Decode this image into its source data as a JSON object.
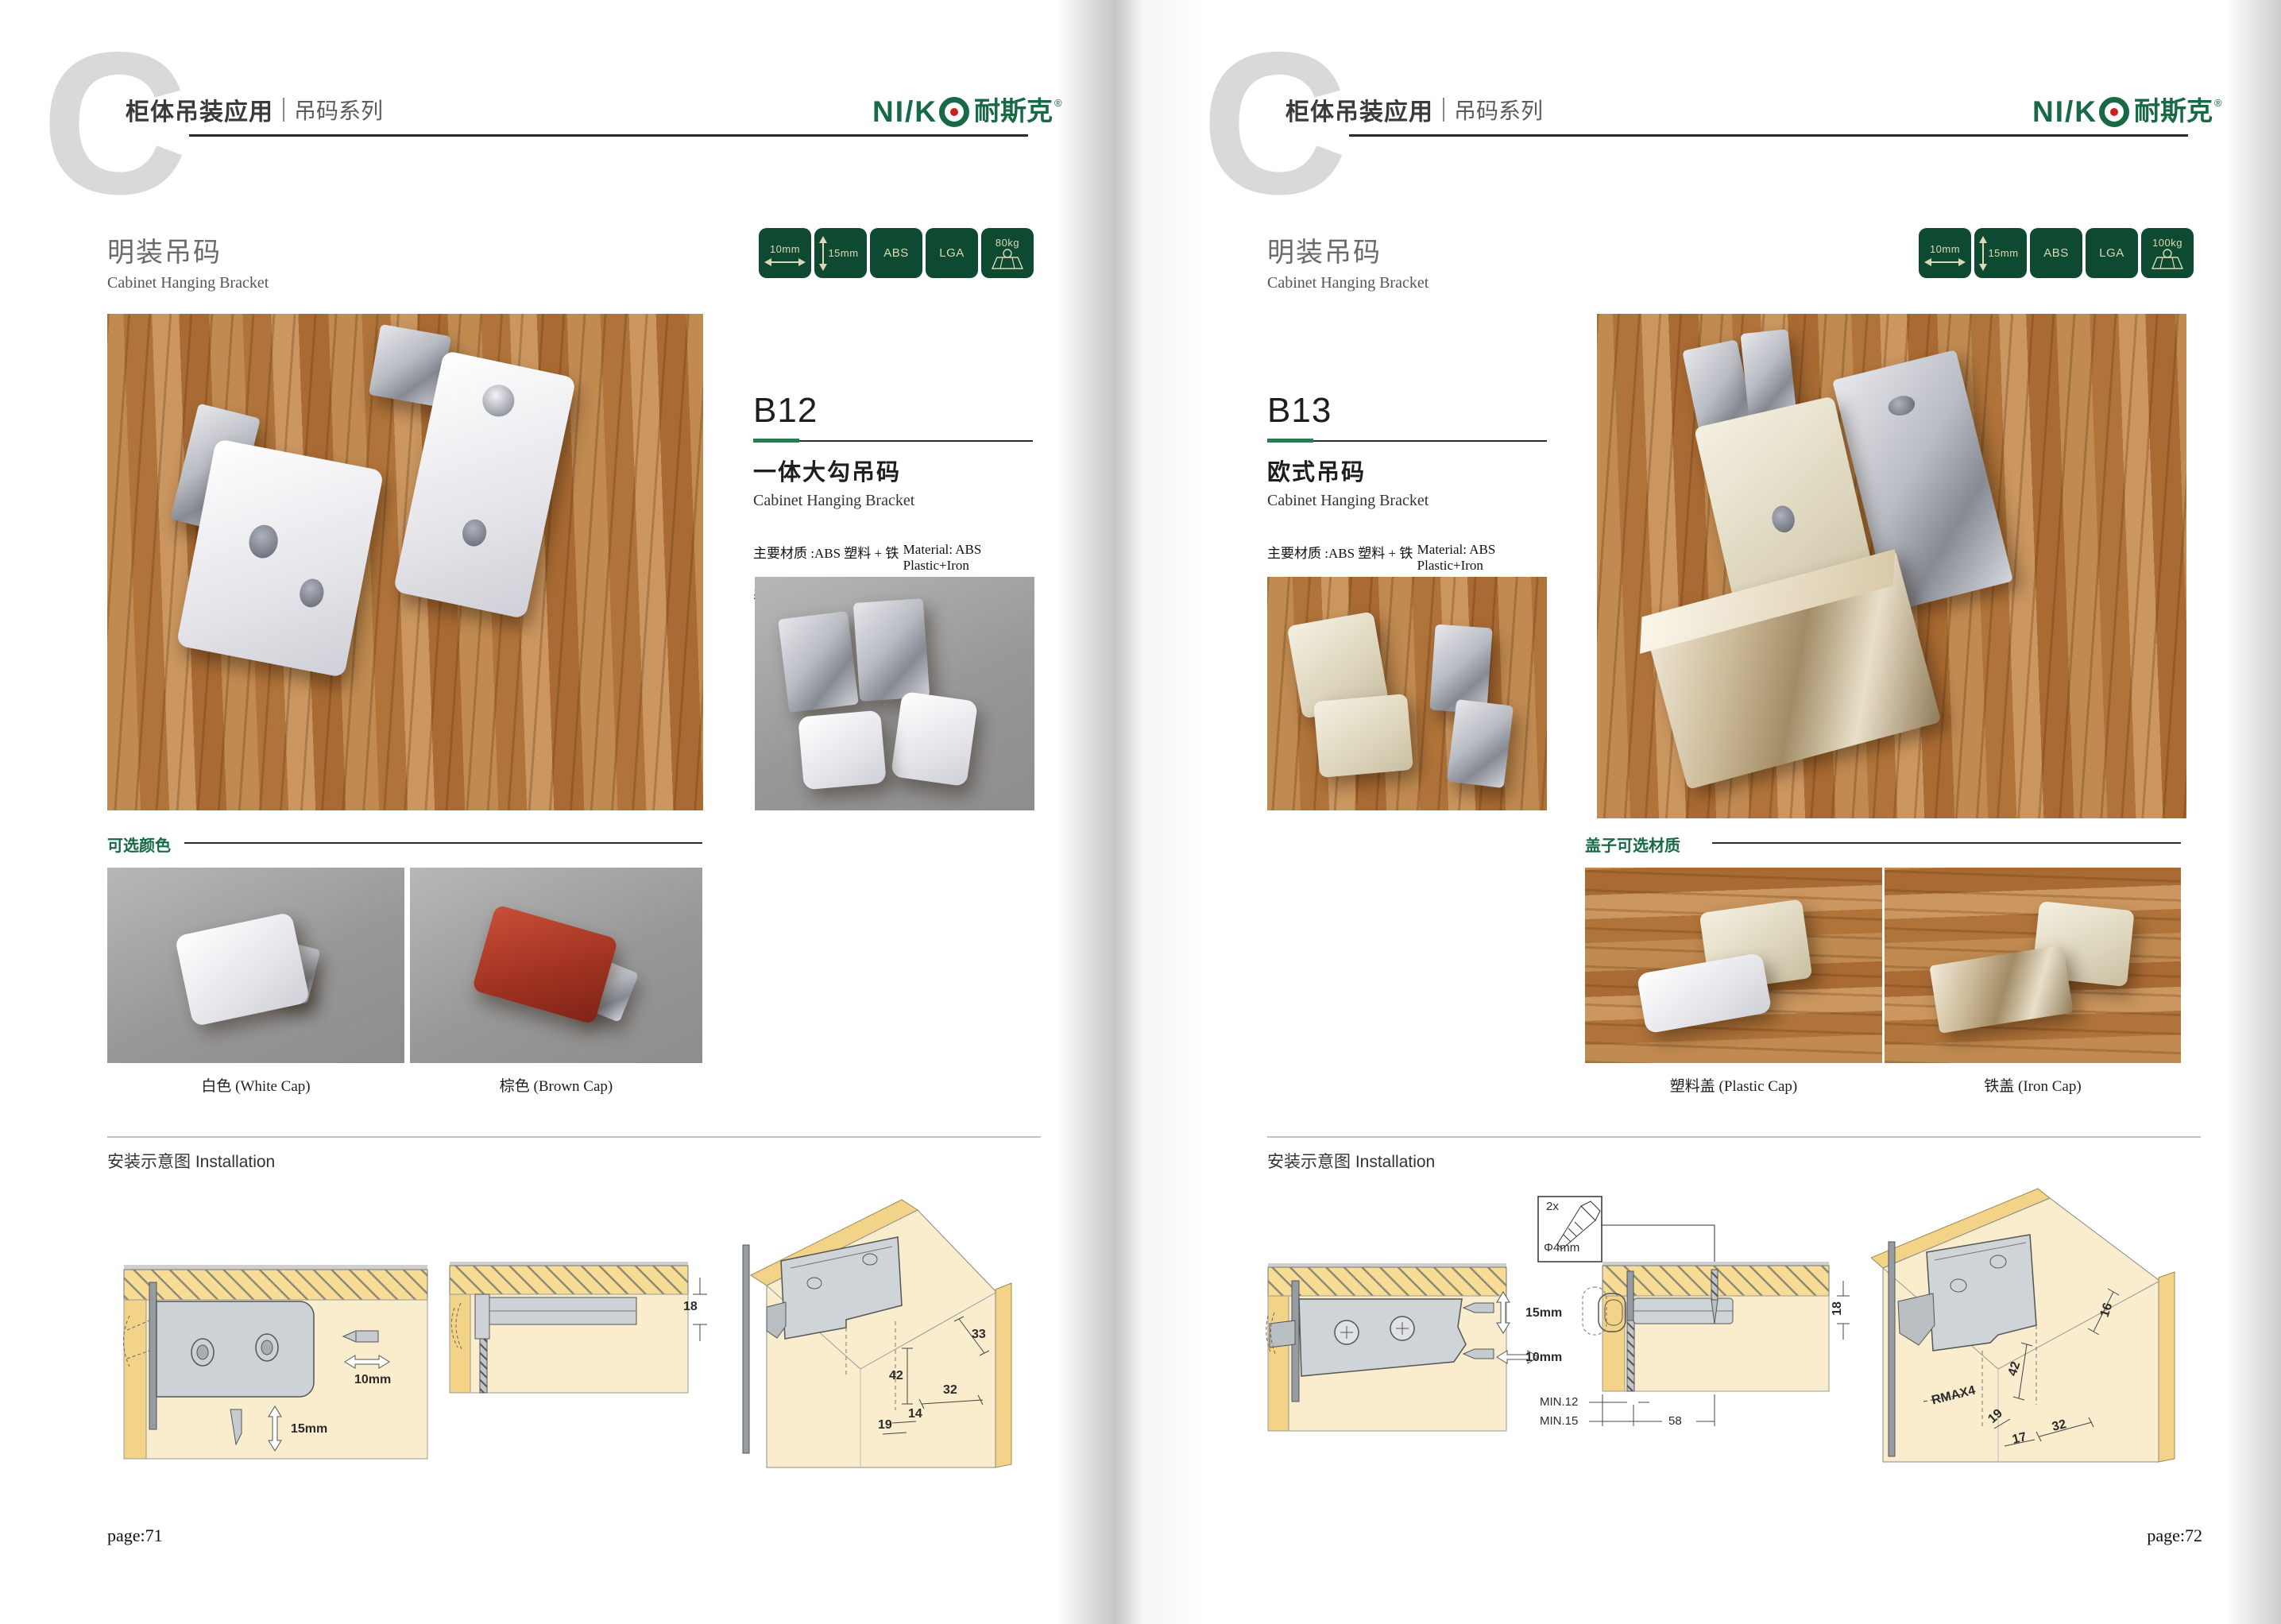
{
  "left": {
    "watermark": "C",
    "header_title": "柜体吊装应用",
    "header_subtitle": "吊码系列",
    "logo_latin": "NI/K",
    "logo_cn": "耐斯克",
    "logo_reg": "®",
    "section_title_cn": "明装吊码",
    "section_title_en": "Cabinet Hanging Bracket",
    "badges": [
      {
        "label": "10mm"
      },
      {
        "label": "15mm"
      },
      {
        "label": "ABS"
      },
      {
        "label": "LGA"
      },
      {
        "label": "80kg"
      }
    ],
    "product": {
      "code": "B12",
      "name_cn": "一体大勾吊码",
      "name_en": "Cabinet Hanging Bracket",
      "spec1_cn": "主要材质 :ABS 塑料 + 铁",
      "spec1_en": "Material: ABS Plastic+Iron",
      "spec2_cn": "表面处理 : 白色、棕色",
      "spec2_en": "Finish:White,Brown"
    },
    "options_label": "可选颜色",
    "option1_caption": "白色 (White Cap)",
    "option2_caption": "棕色 (Brown Cap)",
    "install_label": "安装示意图 Installation",
    "d1_h": "10mm",
    "d1_v": "15mm",
    "d2_dim": "18",
    "d3_dim_a": "33",
    "d3_dim_b": "42",
    "d3_dim_c": "32",
    "d3_dim_d": "14",
    "d3_dim_e": "19",
    "page_label": "page:71"
  },
  "right": {
    "watermark": "C",
    "header_title": "柜体吊装应用",
    "header_subtitle": "吊码系列",
    "logo_latin": "NI/K",
    "logo_cn": "耐斯克",
    "logo_reg": "®",
    "section_title_cn": "明装吊码",
    "section_title_en": "Cabinet Hanging Bracket",
    "badges": [
      {
        "label": "10mm"
      },
      {
        "label": "15mm"
      },
      {
        "label": "ABS"
      },
      {
        "label": "LGA"
      },
      {
        "label": "100kg"
      }
    ],
    "product": {
      "code": "B13",
      "name_cn": "欧式吊码",
      "name_en": "Cabinet Hanging Bracket",
      "spec1_cn": "主要材质 :ABS 塑料 + 铁",
      "spec1_en": "Material: ABS Plastic+Iron",
      "spec2_cn": "表面处理 : 镀镍",
      "spec2_en": "Finish:Nickel plating"
    },
    "options_label": "盖子可选材质",
    "option1_caption": "塑料盖 (Plastic Cap)",
    "option2_caption": "铁盖 (Iron Cap)",
    "install_label": "安装示意图 Installation",
    "screw_count": "2x",
    "screw_dia": "Φ4mm",
    "d1_v": "15mm",
    "d1_h": "10mm",
    "d2_dim": "18",
    "d2_min1": "MIN.12",
    "d2_min2": "MIN.15",
    "d2_w": "58",
    "d3_r": "RMAX4",
    "d3_dim_a": "16",
    "d3_dim_b": "42",
    "d3_dim_c": "19",
    "d3_dim_d": "17",
    "d3_dim_e": "32",
    "page_label": "page:72"
  }
}
